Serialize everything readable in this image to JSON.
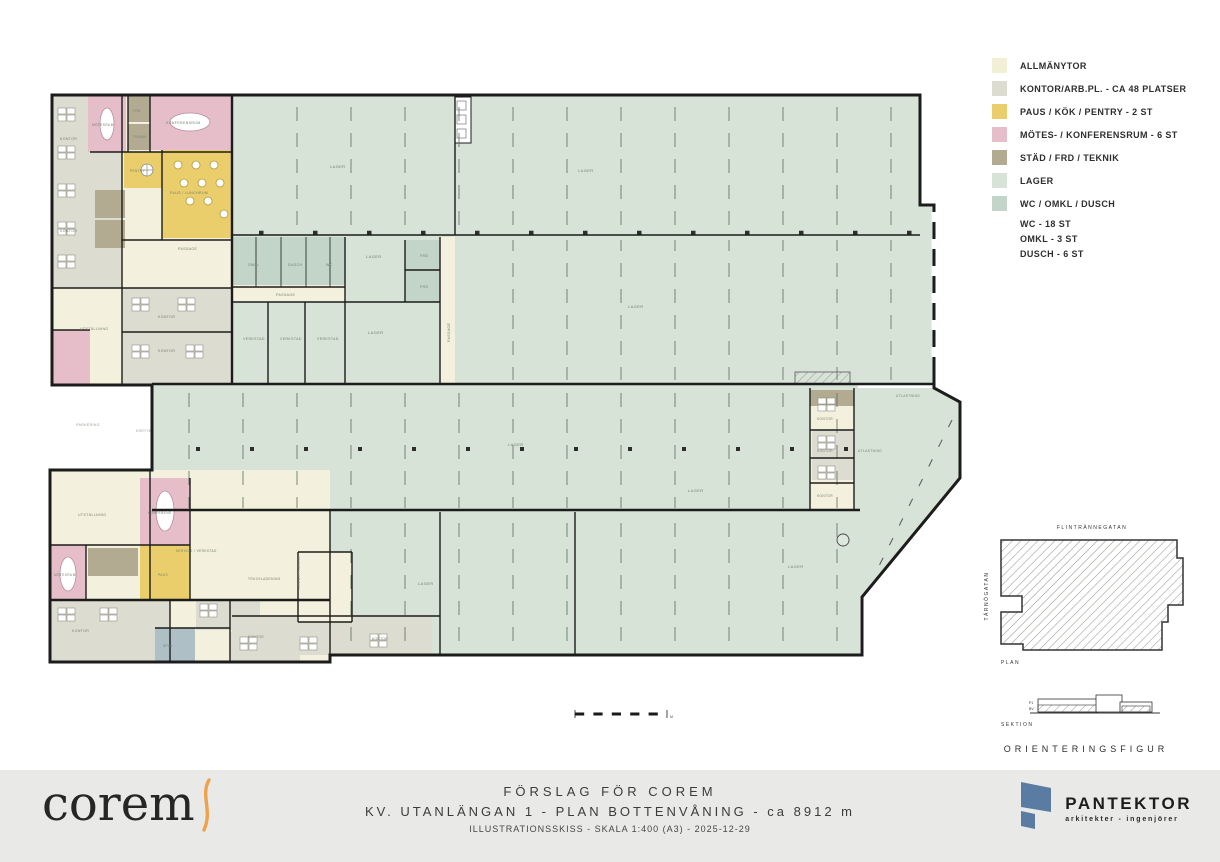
{
  "legend": {
    "items": [
      {
        "label": "ALLMÄNYTOR",
        "color": "#f1efd6"
      },
      {
        "label": "KONTOR/ARB.PL. - CA 48 PLATSER",
        "color": "#dddcd0"
      },
      {
        "label": "PAUS / KÖK / PENTRY - 2 ST",
        "color": "#eace6b"
      },
      {
        "label": "MÖTES- / KONFERENSRUM - 6 ST",
        "color": "#e6bec9"
      },
      {
        "label": "STÄD / FRD / TEKNIK",
        "color": "#b3ab91"
      },
      {
        "label": "LAGER",
        "color": "#d6e3d6"
      },
      {
        "label": "WC / OMKL / DUSCH",
        "color": "#c3d4c9",
        "sub": [
          "WC - 18 ST",
          "OMKL - 3 ST",
          "DUSCH - 6 ST"
        ]
      }
    ]
  },
  "title_block": {
    "line1": "FÖRSLAG FÖR COREM",
    "line2": "KV. UTANLÄNGAN 1  -  PLAN BOTTENVÅNING  -  ca 8912 m",
    "line3": "ILLUSTRATIONSSKISS - SKALA 1:400 (A3) - 2025-12-29"
  },
  "logos": {
    "corem": "corem",
    "pantektor": "PANTEKTOR",
    "pantektor_sub": "arkitekter - ingenjörer"
  },
  "orientation": {
    "street_top": "FLINTRÄNNEGATAN",
    "street_left": "TÄRNÖGATAN",
    "plan_label": "PLAN",
    "section_label": "SEKTION",
    "tag_p1": "P1",
    "tag_bv": "BV",
    "caption": "ORIENTERINGSFIGUR"
  },
  "scalebar": {
    "unit": "M"
  },
  "plan": {
    "labels": [
      {
        "t": "LAGER",
        "x": 330,
        "y": 168
      },
      {
        "t": "LAGER",
        "x": 578,
        "y": 172
      },
      {
        "t": "LAGER",
        "x": 366,
        "y": 258
      },
      {
        "t": "LAGER",
        "x": 368,
        "y": 334
      },
      {
        "t": "LAGER",
        "x": 628,
        "y": 308
      },
      {
        "t": "FRD",
        "x": 420,
        "y": 257,
        "s": 3.5
      },
      {
        "t": "FRD",
        "x": 420,
        "y": 288,
        "s": 3.5
      },
      {
        "t": "PASSAGE",
        "x": 450,
        "y": 342,
        "r": -90,
        "s": 3.5
      },
      {
        "t": "OMKL",
        "x": 248,
        "y": 266,
        "s": 3.5
      },
      {
        "t": "DUSCH",
        "x": 288,
        "y": 266,
        "s": 3.5
      },
      {
        "t": "WC",
        "x": 326,
        "y": 266,
        "s": 3.5
      },
      {
        "t": "PASSAGE",
        "x": 276,
        "y": 296,
        "s": 3.5
      },
      {
        "t": "VERKSTAD",
        "x": 243,
        "y": 340,
        "s": 3.5
      },
      {
        "t": "VERKSTAD",
        "x": 280,
        "y": 340,
        "s": 3.5
      },
      {
        "t": "VERKSTAD",
        "x": 317,
        "y": 340,
        "s": 3.5
      },
      {
        "t": "KONTOR",
        "x": 60,
        "y": 140,
        "s": 3.5
      },
      {
        "t": "KONTOR",
        "x": 60,
        "y": 232,
        "s": 3.5
      },
      {
        "t": "UTSTÄLLNING",
        "x": 80,
        "y": 330,
        "s": 3.5
      },
      {
        "t": "KONTOR",
        "x": 158,
        "y": 318,
        "s": 3.5
      },
      {
        "t": "KONTOR",
        "x": 158,
        "y": 352,
        "s": 3.5
      },
      {
        "t": "PASSAGE",
        "x": 178,
        "y": 250,
        "s": 3.5
      },
      {
        "t": "KONFERENSRUM",
        "x": 166,
        "y": 124,
        "s": 3.5
      },
      {
        "t": "MÖTESRUM",
        "x": 92,
        "y": 126,
        "s": 3.2
      },
      {
        "t": "PAUS / LUNCHRUM",
        "x": 170,
        "y": 194,
        "s": 3.5
      },
      {
        "t": "PENTRY",
        "x": 130,
        "y": 172,
        "s": 3.2
      },
      {
        "t": "FRD",
        "x": 133,
        "y": 112,
        "s": 3.2
      },
      {
        "t": "TEKNIK",
        "x": 133,
        "y": 138,
        "s": 3.2
      },
      {
        "t": "PARKERING",
        "x": 76,
        "y": 426,
        "s": 3.5,
        "c": "#9b988c"
      },
      {
        "t": "KÖRYTA",
        "x": 136,
        "y": 432,
        "s": 3.2,
        "c": "#9b988c"
      },
      {
        "t": "LAGER",
        "x": 508,
        "y": 446
      },
      {
        "t": "LAGER",
        "x": 688,
        "y": 492
      },
      {
        "t": "KONTOR",
        "x": 817,
        "y": 420,
        "s": 3.2
      },
      {
        "t": "KONTOR",
        "x": 817,
        "y": 452,
        "s": 3.2
      },
      {
        "t": "KONTOR",
        "x": 817,
        "y": 497,
        "s": 3.2
      },
      {
        "t": "UTLASTNING",
        "x": 858,
        "y": 452,
        "s": 3.2
      },
      {
        "t": "UTLASTNING",
        "x": 896,
        "y": 397,
        "s": 3.2
      },
      {
        "t": "UTSTÄLLNING",
        "x": 78,
        "y": 516,
        "s": 3.5
      },
      {
        "t": "KONFERENS",
        "x": 148,
        "y": 514,
        "s": 3.2
      },
      {
        "t": "MÖTESRUM",
        "x": 54,
        "y": 576,
        "s": 3.2
      },
      {
        "t": "PAUS",
        "x": 158,
        "y": 576,
        "s": 3.2
      },
      {
        "t": "KONTOR",
        "x": 72,
        "y": 632,
        "s": 3.5
      },
      {
        "t": "SERVICE / VERKSTAD",
        "x": 176,
        "y": 552,
        "s": 3.2
      },
      {
        "t": "TRUCKLADDNING",
        "x": 248,
        "y": 580,
        "s": 3.2
      },
      {
        "t": "VARUMOTTAGNING",
        "x": 300,
        "y": 590,
        "s": 3,
        "r": -90
      },
      {
        "t": "SPOL",
        "x": 163,
        "y": 647,
        "s": 3.2
      },
      {
        "t": "KONTOR",
        "x": 248,
        "y": 638,
        "s": 3.2
      },
      {
        "t": "KONTOR",
        "x": 372,
        "y": 640,
        "s": 3.2
      },
      {
        "t": "LAGER",
        "x": 418,
        "y": 585
      },
      {
        "t": "LAGER",
        "x": 788,
        "y": 568
      },
      {
        "t": "M",
        "x": 670,
        "y": 718,
        "s": 3.5,
        "c": "#444444"
      }
    ]
  }
}
